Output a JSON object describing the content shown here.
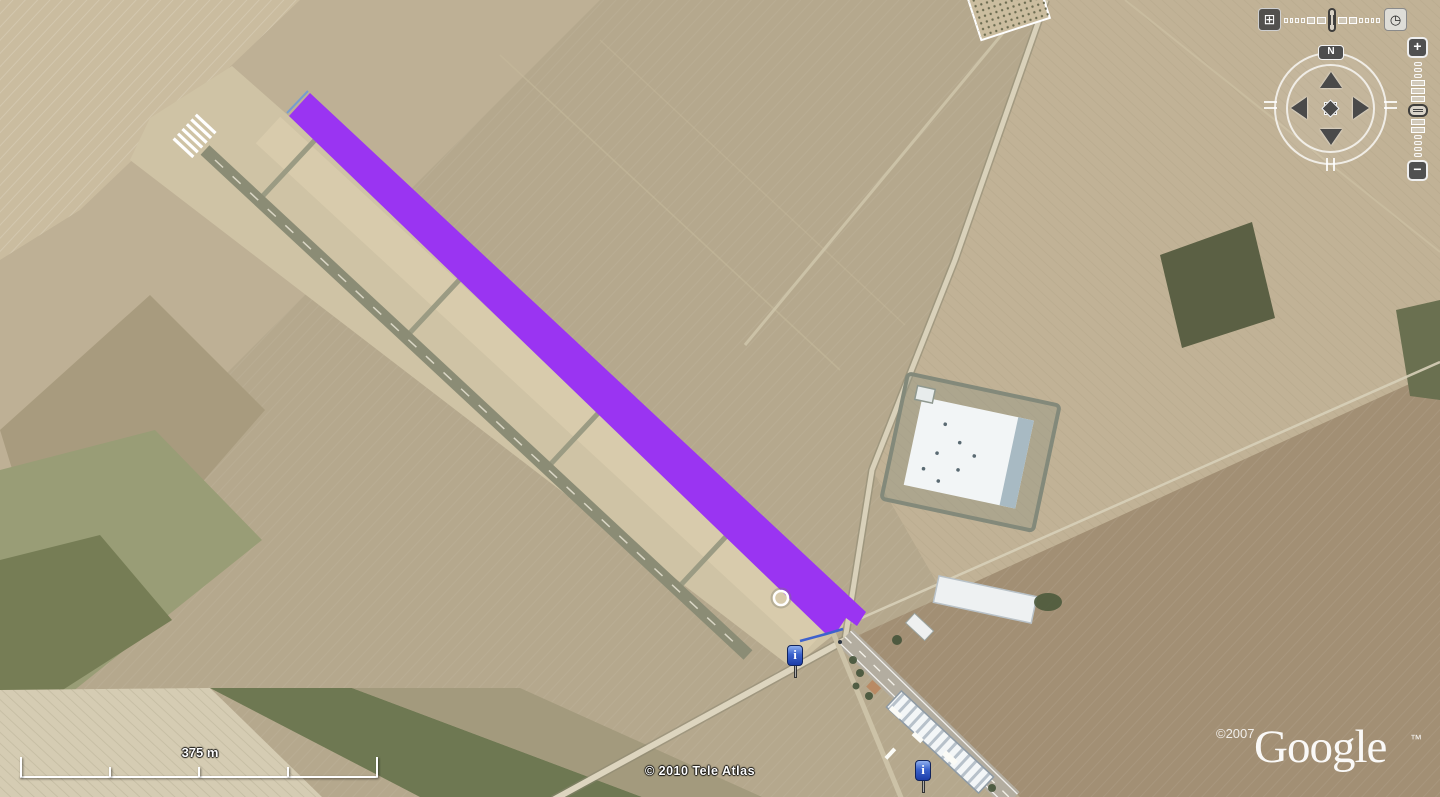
{
  "map": {
    "attribution": "© 2010 Tele Atlas",
    "logo": {
      "copyright": "©2007",
      "brand": "Google",
      "trademark": "™"
    },
    "scale_bar": {
      "label": "375 m"
    },
    "overlay": {
      "label": "highlighted-runway",
      "fill_color": "#9a34f2",
      "outline_color": "#3f62cc"
    },
    "markers": [
      {
        "type": "info",
        "glyph": "i"
      },
      {
        "type": "info",
        "glyph": "i"
      }
    ]
  },
  "controls": {
    "imagery_toolbar": {
      "adjust_icon": "⊞",
      "time_icon": "◷"
    },
    "compass": {
      "north_label": "N"
    },
    "zoom_slider": {
      "zoom_in_label": "+",
      "zoom_out_label": "−"
    }
  }
}
